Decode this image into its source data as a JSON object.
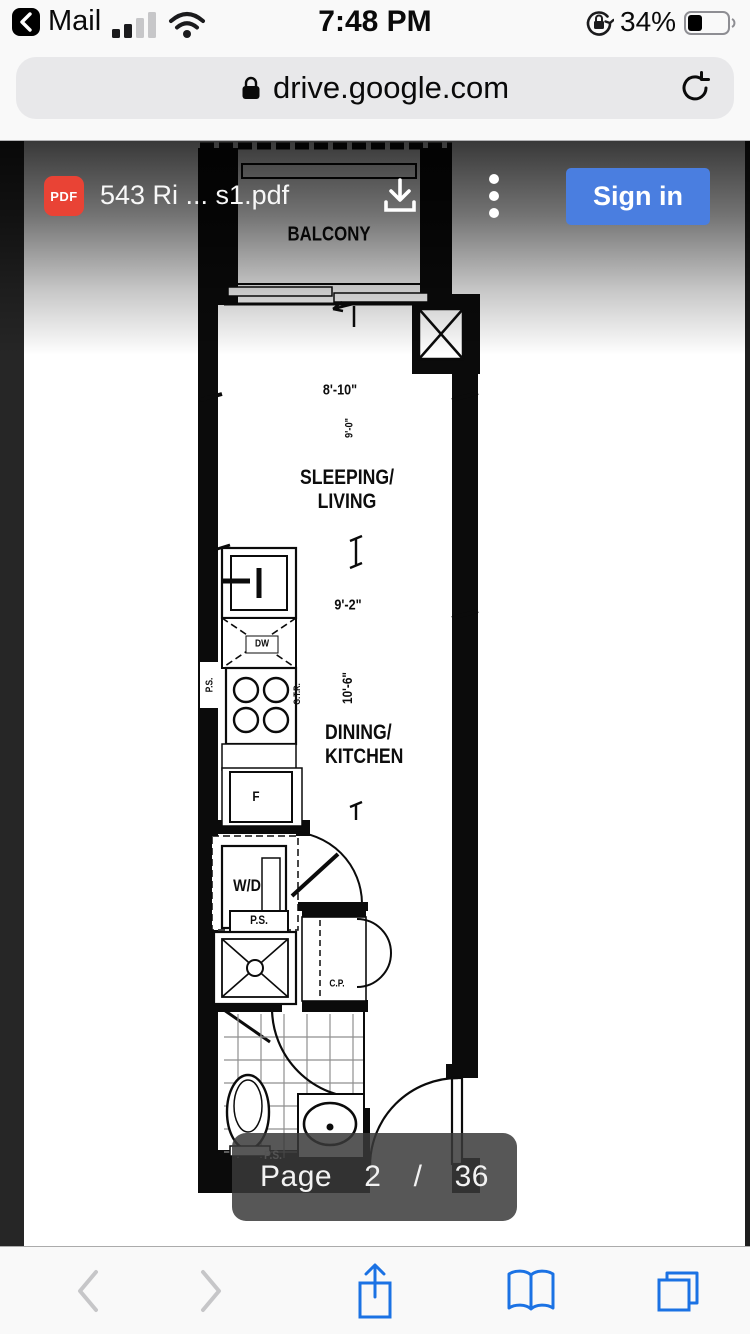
{
  "status_bar": {
    "back_app": "Mail",
    "time": "7:48 PM",
    "battery_percent": "34%"
  },
  "url_bar": {
    "url": "drive.google.com"
  },
  "viewer_header": {
    "pdf_badge": "PDF",
    "title": "543 Ri ... s1.pdf",
    "sign_in_label": "Sign in"
  },
  "floor_plan": {
    "labels": {
      "balcony": "BALCONY",
      "sleeping_living": "SLEEPING/\nLIVING",
      "dining_kitchen": "DINING/\nKITCHEN",
      "dim_top": "8'-10\"",
      "dim_top_vert": "9'-0\"",
      "dim_mid": "9'-2\"",
      "dim_mid_vert": "10'-6\"",
      "washer_dryer": "W/D",
      "dishwasher": "DW",
      "fridge": "F",
      "pipe_shaft_kitchen": "P.S.",
      "gas_range": "G.T.R.",
      "pipe_shaft_mid": "P.S.",
      "closet": "C.P.",
      "pipe_shaft_bottom": "P.S."
    }
  },
  "page_indicator": {
    "label": "Page",
    "current": "2",
    "separator": "/",
    "total": "36"
  },
  "icons": {
    "back-to-app-icon": "chevron-left-in-black-chip",
    "cellular-signal-icon": "2-of-4-bars",
    "wifi-icon": "wifi-full",
    "rotation-lock-icon": "lock-with-circular-arrow",
    "battery-icon": "battery-34-filled",
    "lock-icon": "padlock",
    "reload-icon": "circular-arrow",
    "pdf-icon": "red-pdf-badge",
    "download-icon": "tray-arrow-down",
    "overflow-menu-icon": "vertical-three-dots",
    "back-icon": "chevron-left",
    "forward-icon": "chevron-right",
    "share-icon": "box-arrow-up",
    "bookmarks-icon": "open-book",
    "tabs-icon": "overlapping-squares"
  },
  "colors": {
    "pdf_badge_red": "#e94335",
    "sign_in_blue": "#4a7ee0",
    "toolbar_blue": "#1b72e4",
    "viewer_side_strip": "#262626",
    "indicator_bg": "rgba(58,58,58,0.85)"
  }
}
